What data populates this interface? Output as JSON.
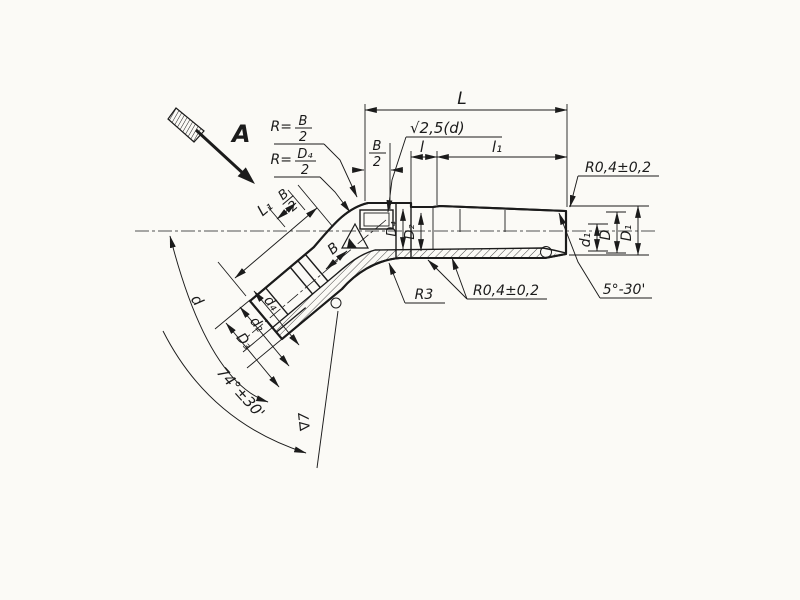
{
  "drawing": {
    "paper_color": "#fbfaf6",
    "ink_color": "#1b1b1b",
    "view": {
      "label": "A"
    },
    "leaders": {
      "outer_radius": {
        "prefix": "R=",
        "num": "B",
        "den": "2"
      },
      "inner_radius": {
        "prefix": "R=",
        "num": "D₄",
        "den": "2"
      },
      "finish_note": "√2,5(d)",
      "corner_radius_top": "R0,4±0,2",
      "corner_radius_bottom": "R0,4±0,2",
      "fillet_radius": "R3",
      "taper_angle": "5°-30'"
    },
    "dims": {
      "L": "L",
      "b_half_num": "B",
      "b_half_den": "2",
      "l": "l",
      "l1": "l₁",
      "d1": "d₁",
      "D": "D",
      "D1": "D₁",
      "D4": "D₄",
      "D2": "D₂",
      "B": "B",
      "arm_b_half_num": "B",
      "arm_b_half_den": "2",
      "L1": "L₁",
      "d4": "d₄",
      "d2": "d₂",
      "D3": "D₃",
      "d": "d",
      "bend_angle": "74°±30'",
      "finish7": "∇7"
    }
  }
}
